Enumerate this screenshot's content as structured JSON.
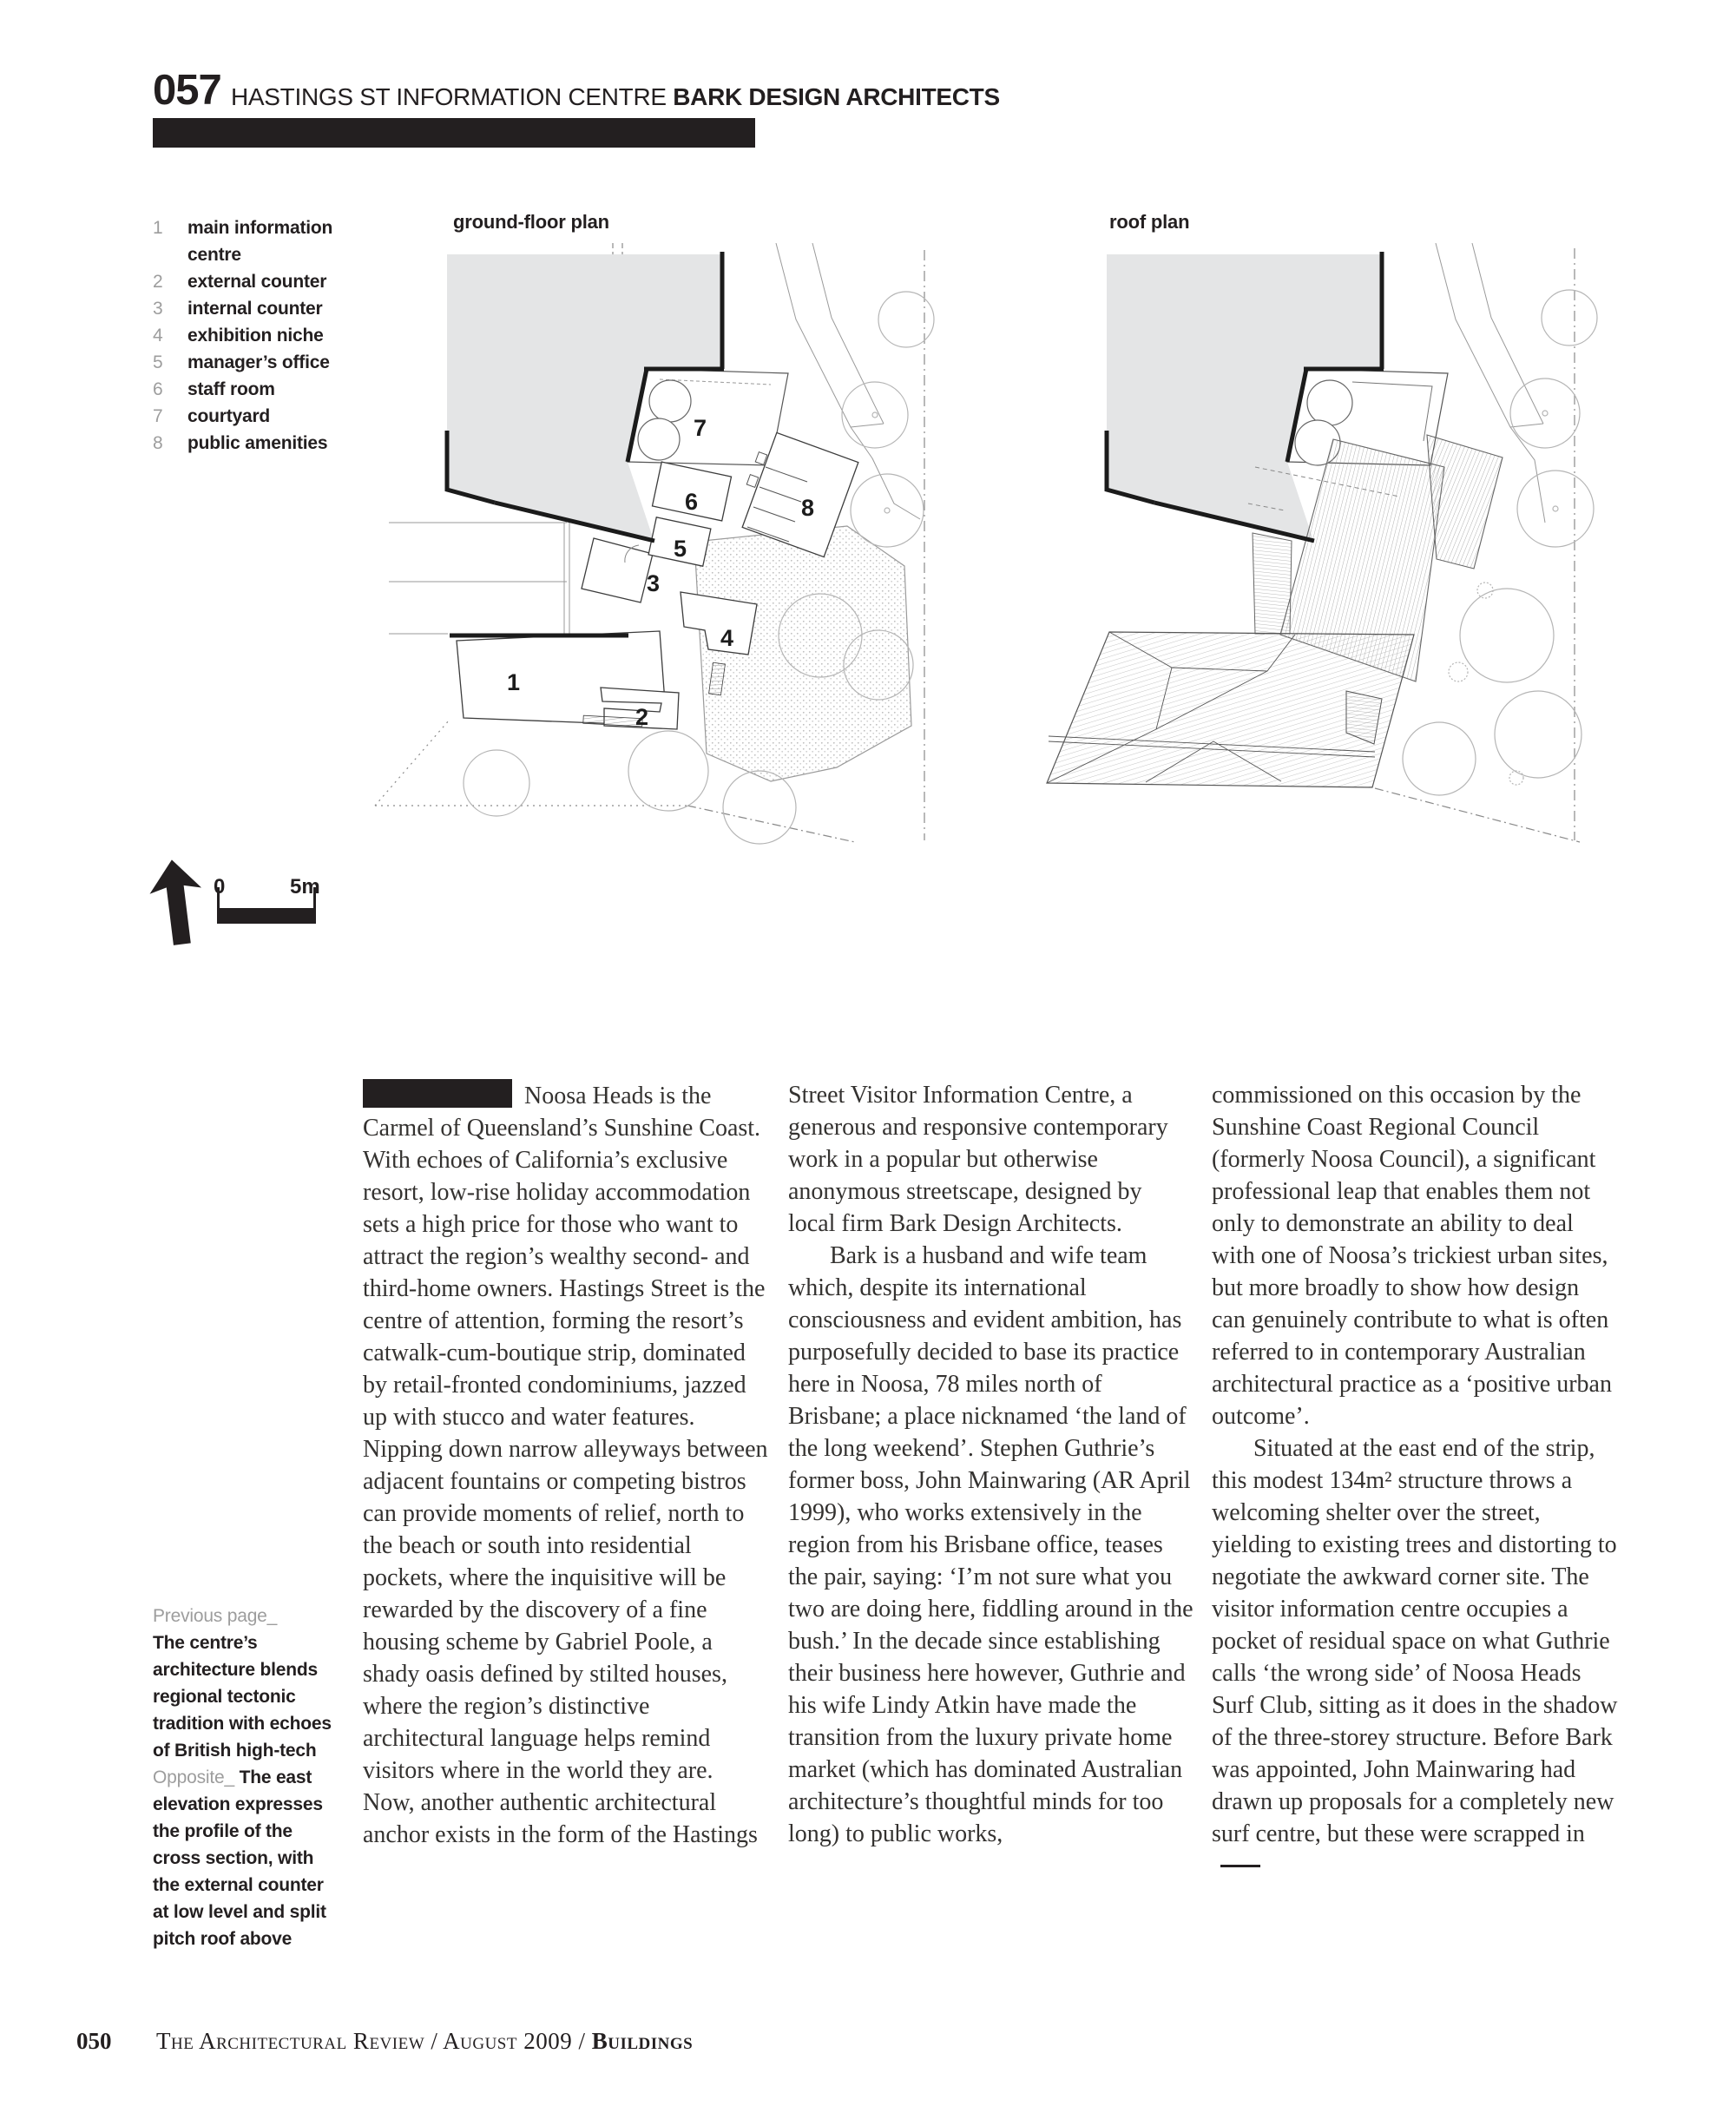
{
  "header": {
    "number": "057",
    "title": "HASTINGS ST INFORMATION CENTRE ",
    "architect": "BARK DESIGN ARCHITECTS"
  },
  "legend": [
    {
      "num": "1",
      "label": "main information centre"
    },
    {
      "num": "2",
      "label": "external counter"
    },
    {
      "num": "3",
      "label": "internal counter"
    },
    {
      "num": "4",
      "label": "exhibition niche"
    },
    {
      "num": "5",
      "label": "manager’s office"
    },
    {
      "num": "6",
      "label": "staff room"
    },
    {
      "num": "7",
      "label": "courtyard"
    },
    {
      "num": "8",
      "label": "public amenities"
    }
  ],
  "plans": {
    "ground_label": "ground-floor plan",
    "roof_label": "roof plan",
    "room_numbers": [
      "1",
      "2",
      "3",
      "4",
      "5",
      "6",
      "7",
      "8"
    ]
  },
  "scalebar": {
    "zero": "0",
    "max": "5m"
  },
  "article": {
    "col1_p1": "Noosa Heads is the Carmel of Queensland’s Sunshine Coast. With echoes of California’s exclusive resort, low-rise holiday accommodation sets a high price for those who want to attract the region’s wealthy second- and third-home owners. Hastings Street is the centre of attention, forming the resort’s catwalk-cum-boutique strip, dominated by retail-fronted condominiums, jazzed up with stucco and water features. Nipping down narrow alleyways between adjacent fountains or competing bistros can provide moments of relief, north to the beach or south into residential pockets, where the inquisitive will be rewarded by the discovery of a fine housing scheme by Gabriel Poole, a shady oasis defined by stilted houses, where the region’s distinctive architectural language helps remind visitors where in the world they are. Now, another authentic architectural anchor exists in the form of the Hastings",
    "col2_p1": "Street Visitor Information Centre, a generous and responsive contemporary work in a popular but otherwise anonymous streetscape, designed by local firm Bark Design Architects.",
    "col2_p2": "Bark is a husband and wife team which, despite its international consciousness and evident ambition, has purposefully decided to base its practice here in Noosa, 78 miles north of Brisbane; a place nicknamed ‘the land of the long weekend’. Stephen Guthrie’s former boss, John Mainwaring (AR April 1999), who works extensively in the region from his Brisbane office, teases the pair, saying: ‘I’m not sure what you two are doing here, fiddling around in the bush.’ In the decade since establishing their business here however, Guthrie and his wife Lindy Atkin have made the transition from the luxury private home market (which has dominated Australian architecture’s thoughtful minds for too long) to public works,",
    "col3_p1": "commissioned on this occasion by the Sunshine Coast Regional Council (formerly Noosa Council), a significant professional leap that enables them not only to demonstrate an ability to deal with one of Noosa’s trickiest urban sites, but more broadly to show how design can genuinely contribute to what is often referred to in contemporary Australian architectural practice as a ‘positive urban outcome’.",
    "col3_p2": "Situated at the east end of the strip, this modest 134m² structure throws a welcoming shelter over the street, yielding to existing trees and distorting to negotiate the awkward corner site. The visitor information centre occupies a pocket of residual space on what Guthrie calls ‘the wrong side’ of Noosa Heads Surf Club, sitting as it does in the shadow of the three-storey structure. Before Bark was appointed, John Mainwaring had drawn up proposals for a completely new surf centre, but these were scrapped in"
  },
  "caption": {
    "previous_label": "Previous page_",
    "previous_text": "The centre’s architecture blends regional tectonic tradition with echoes of British high-tech",
    "opposite_label": "Opposite_ ",
    "opposite_text": "The east elevation expresses the profile of the cross section, with the external counter at low level and split pitch roof above"
  },
  "footer": {
    "page_number": "050",
    "journal": "The Architectural Review / August 2009 / ",
    "section": "Buildings"
  },
  "colors": {
    "ink": "#231f20",
    "body_text": "#343230",
    "building_gray": "#e4e5e6",
    "legend_num_gray": "#9d9d9d"
  }
}
